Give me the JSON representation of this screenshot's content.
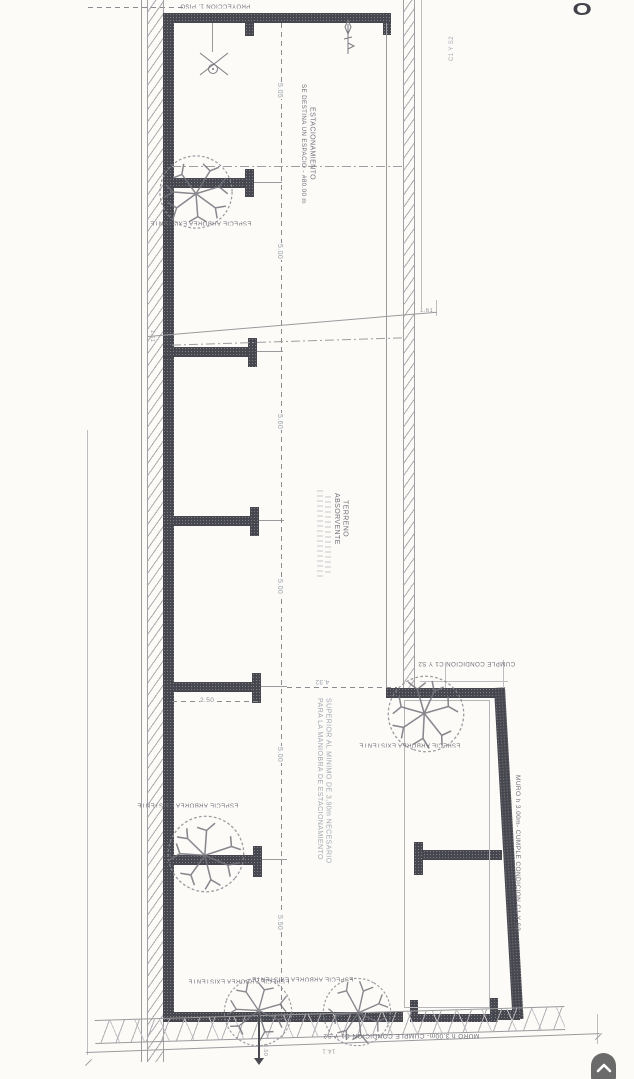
{
  "plan": {
    "labels": {
      "proyeccion": "PROYECCION 1. PISO",
      "estacionamiento": "ESTACIONAMIENTO",
      "se_destina": "SE DESTINA UN ESPACIO - #80.00 m",
      "terreno": "TERRENO",
      "absorvente": "ABSORVENTE",
      "superior": "SUPERIOR AL MINIMO DE 3,90m NECESARIO",
      "para_la": "PARA LA MANIOBRA DE ESTACIONAMIENTO",
      "cumple": "CUMPLE CONDICION C1 Y S2",
      "muro": "MURO h 3.00m- CUMPLE CONDICION C1 Y S2",
      "especie": "ESPECIE ARBOREA EXISTENTE",
      "wall_note_fragment": "C1 Y S2",
      "letter_fragment": "O"
    },
    "dims": {
      "stall": [
        "5.05",
        "5.00",
        "5.60",
        "5.00",
        "5.00",
        "5.50"
      ],
      "bay": "2.50",
      "maneuver": "4.32",
      "edge_right": "1.61",
      "edge_left": "1.61",
      "tree_offset": "2.50",
      "total": "14.1"
    }
  },
  "fab": {
    "icon": "chevron-up"
  }
}
